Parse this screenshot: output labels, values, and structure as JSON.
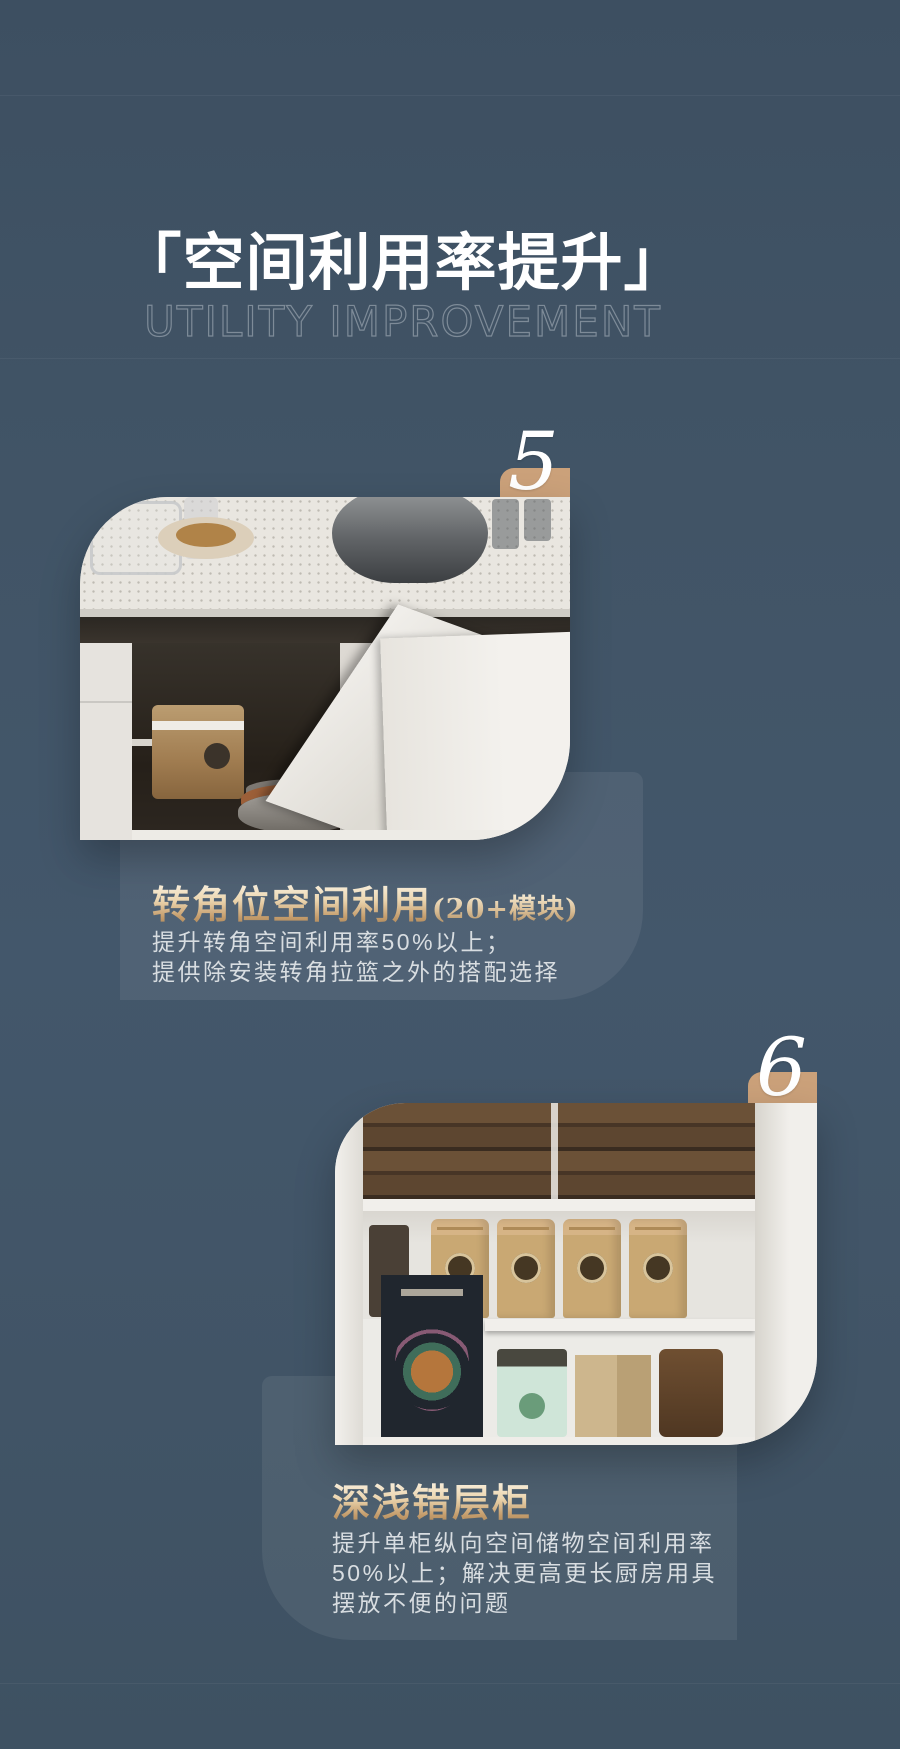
{
  "header": {
    "title_cn": "「空间利用率提升」",
    "title_en": "UTILITY IMPROVEMENT"
  },
  "sections": [
    {
      "number": "5",
      "heading": "转角位空间利用",
      "heading_note": "(20+模块)",
      "body_lines": [
        "提升转角空间利用率50%以上；",
        "提供除安装转角拉篮之外的搭配选择"
      ],
      "photo": "corner-cabinet-kitchen-photo"
    },
    {
      "number": "6",
      "heading": "深浅错层柜",
      "heading_note": "",
      "body_lines": [
        "提升单柜纵向空间储物空间利用率",
        "50%以上；解决更高更长厨房用具",
        "摆放不便的问题"
      ],
      "photo": "stepped-depth-pantry-photo"
    }
  ],
  "colors": {
    "background": "#415466",
    "panel_overlay": "#4d5f70",
    "tab": "#cba17a",
    "heading_gold_top": "#f8eedb",
    "heading_gold_bottom": "#a8855b",
    "body_text": "#d8dde1",
    "subtitle": "#7e8b98",
    "title": "#ffffff",
    "number": "#ffffff"
  }
}
